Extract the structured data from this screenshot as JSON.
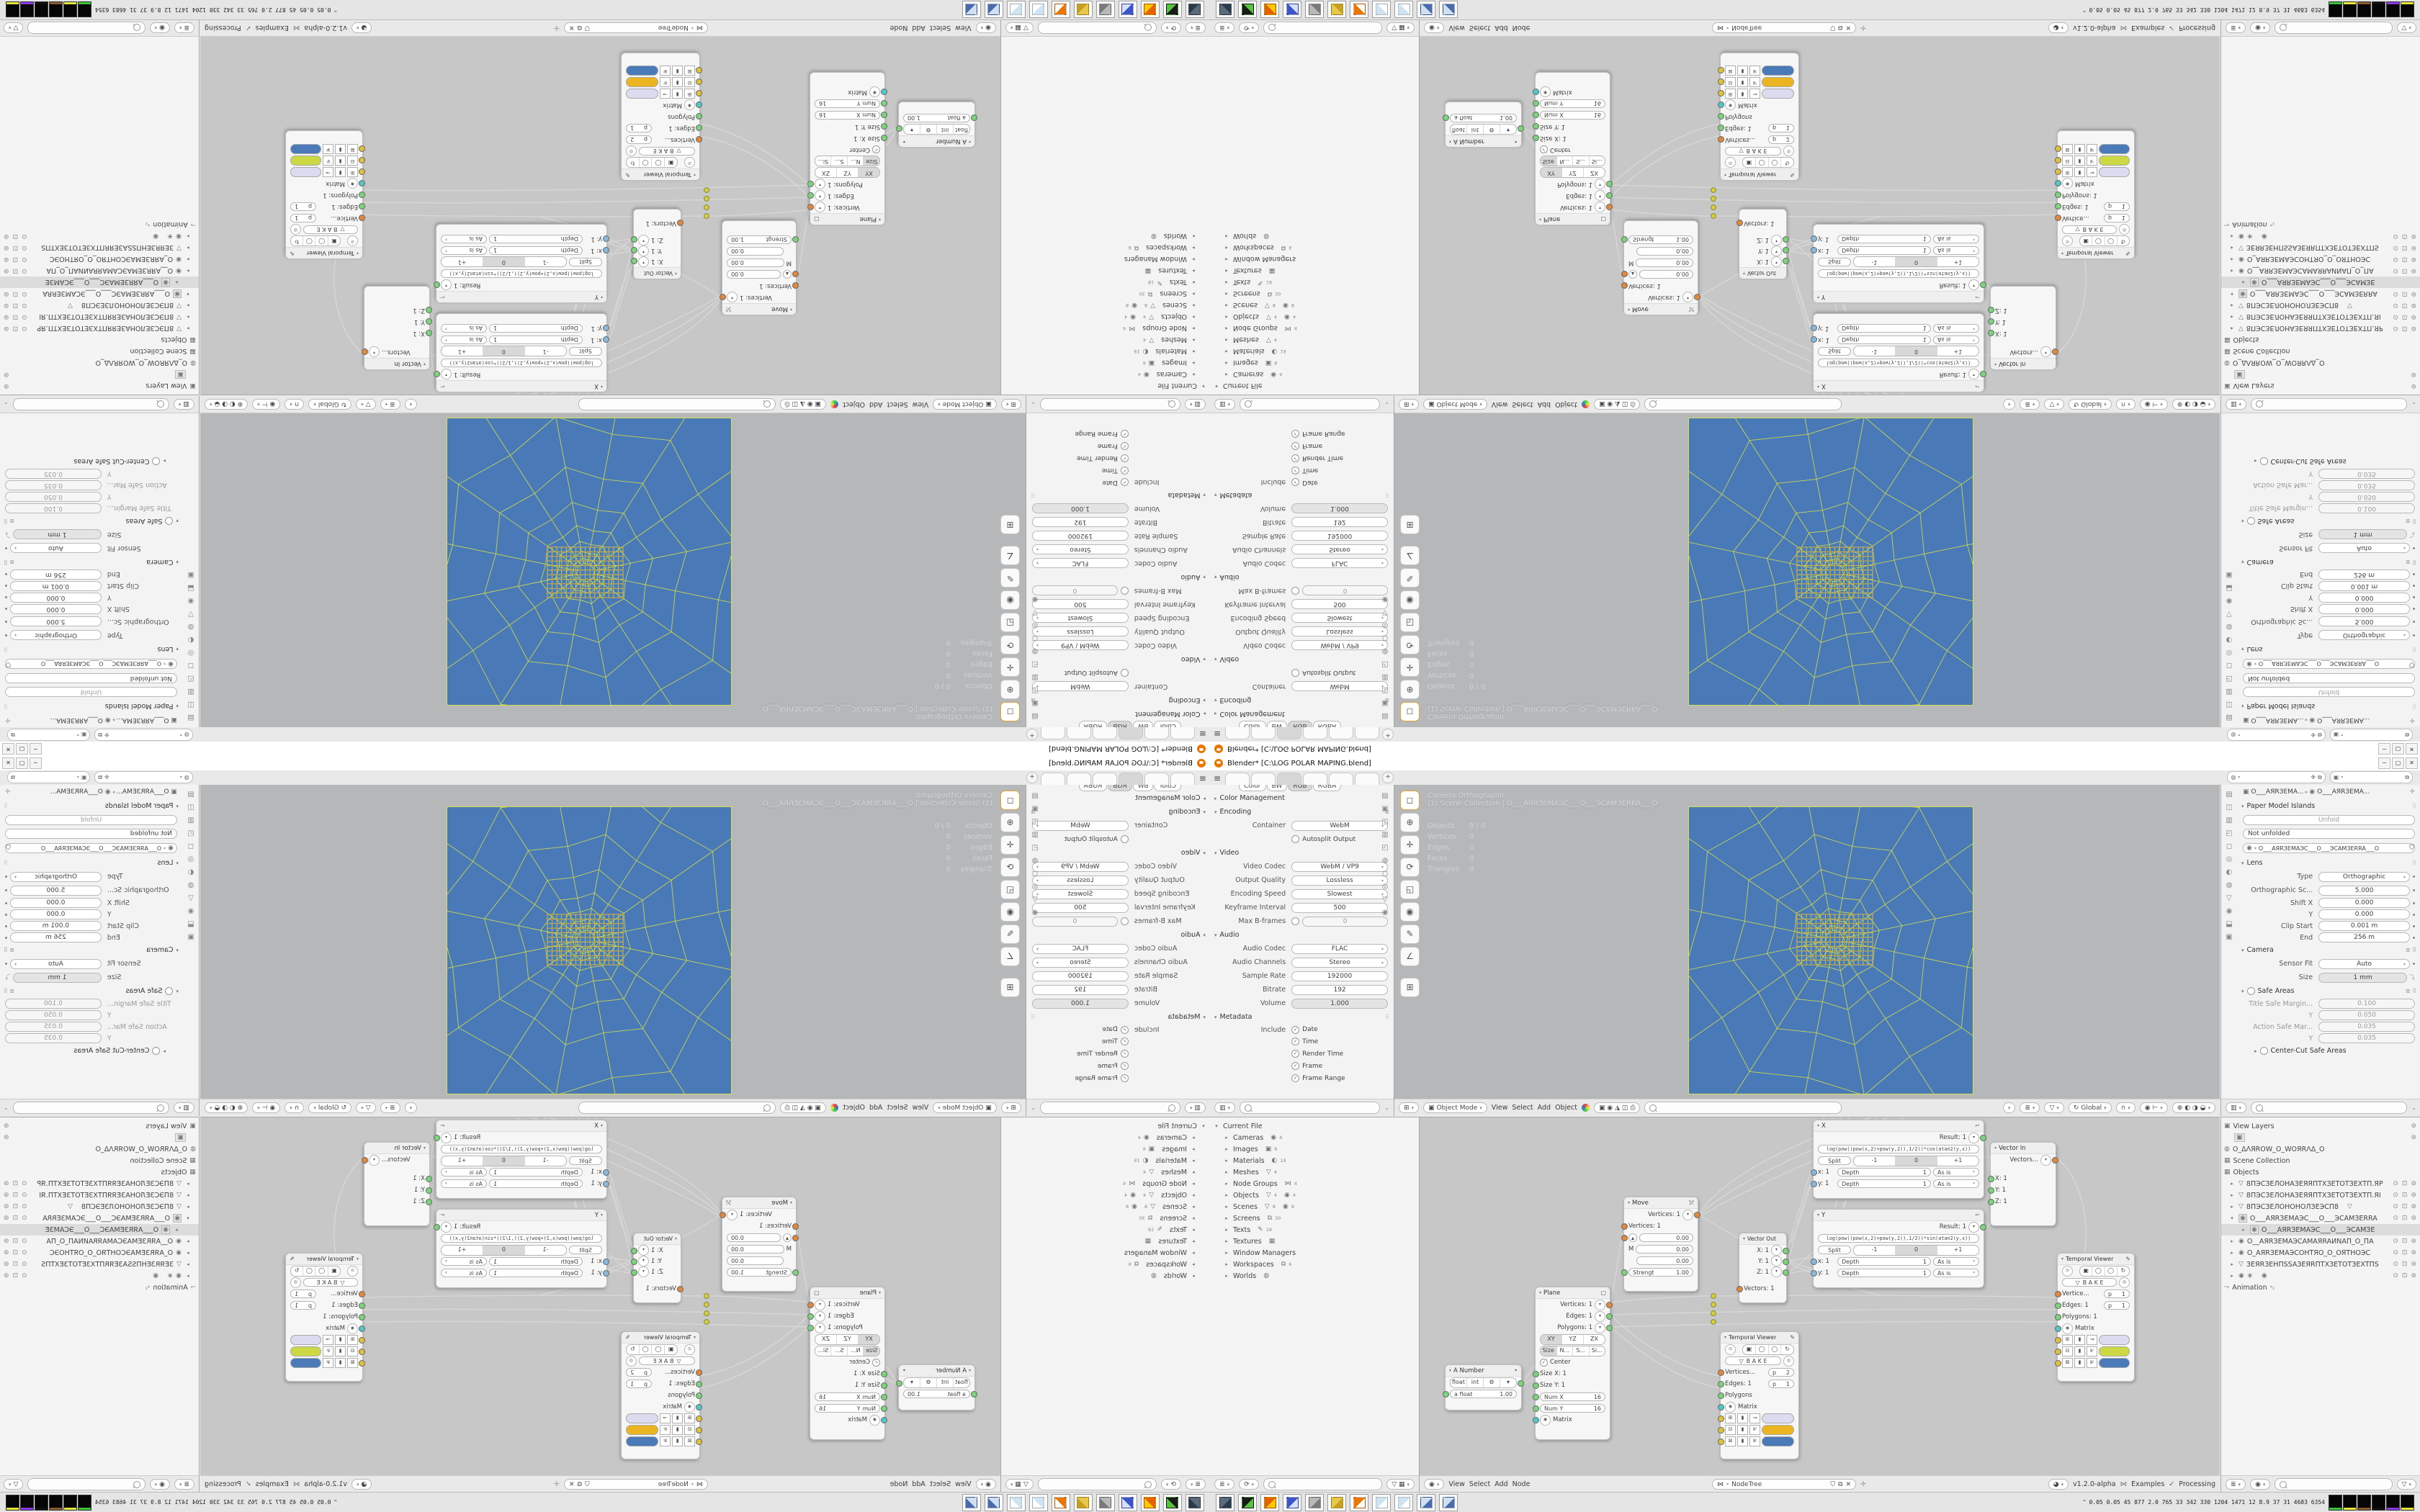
{
  "window": {
    "title": "Blender* [C:\\LOG POLAR MAPING.blend]",
    "buttons": [
      "─",
      "▢",
      "✕"
    ]
  },
  "topbar": {
    "tab_count": 6,
    "add": "+",
    "version_hint": ""
  },
  "output_props": {
    "color_row": [
      "Color",
      "BW",
      "RGB",
      "RGBA"
    ],
    "color_management": "Color Management",
    "encoding": "Encoding",
    "container_label": "Container",
    "container": "WebM",
    "autosplit": "Autosplit Output",
    "video": "Video",
    "video_codec_label": "Video Codec",
    "video_codec": "WebM / VP9",
    "output_quality_label": "Output Quality",
    "output_quality": "Lossless",
    "encoding_speed_label": "Encoding Speed",
    "encoding_speed": "Slowest",
    "keyframe_label": "Keyframe Interval",
    "keyframe": "500",
    "maxb_label": "Max B-frames",
    "maxb": "0",
    "audio": "Audio",
    "audio_codec_label": "Audio Codec",
    "audio_codec": "FLAC",
    "audio_channels_label": "Audio Channels",
    "audio_channels": "Stereo",
    "sample_rate_label": "Sample Rate",
    "sample_rate": "192000",
    "bitrate_label": "Bitrate",
    "bitrate": "192",
    "volume_label": "Volume",
    "volume": "1.000",
    "metadata": "Metadata",
    "include": "Include",
    "include_items": [
      "Date",
      "Time",
      "Render Time",
      "Frame",
      "Frame Range"
    ],
    "tab_glyphs": [
      "▤",
      "▣",
      "◫",
      "▥",
      "◰",
      "◍",
      "◻",
      "◎",
      "▽",
      "◉"
    ]
  },
  "viewport": {
    "overlay_line1": "Camera Orthographic",
    "overlay_line2": "(1) Scene Collection | O___AЯRЗEMAЭC___O___ЭCAMЗERRA___O",
    "stats": [
      [
        "Objects",
        "0 / 0"
      ],
      [
        "Vertices",
        "0"
      ],
      [
        "Edges",
        "0"
      ],
      [
        "Faces",
        "0"
      ],
      [
        "Triangles",
        "0"
      ]
    ],
    "toolbar_glyphs": [
      "◻",
      "⊕",
      "✛",
      "⟳",
      "◱",
      "◉",
      "✎",
      "∠",
      "⊞"
    ],
    "header": {
      "mode": "Object Mode",
      "menus": [
        "View",
        "Select",
        "Add",
        "Object"
      ],
      "orient": "Global"
    },
    "plane_color": "#4a79b8",
    "wire_color": "#ccd94e",
    "vertex_color": "#d89030"
  },
  "camera_props": {
    "breadcrumb_a": "O___AЯRЗEMA...",
    "breadcrumb_b": "O___AЯRЗEMA...",
    "paper_title": "Paper Model Islands",
    "unfold": "Unfold",
    "not_unfolded": "Not unfolded",
    "datablock": "O___AЯRЗEMAЭC___O___ЭCAMЗERRA___O",
    "lens": "Lens",
    "type_label": "Type",
    "type": "Orthographic",
    "ortho_label": "Orthographic Sc...",
    "ortho": "5.000",
    "shiftx_label": "Shift X",
    "shiftx": "0.000",
    "shifty_label": "Y",
    "shifty": "0.000",
    "clip_label": "Clip Start",
    "clip": "0.001 m",
    "end_label": "End",
    "end": "256 m",
    "camera": "Camera",
    "sensor_label": "Sensor Fit",
    "sensor": "Auto",
    "size_label": "Size",
    "size": "1 mm",
    "safe": "Safe Areas",
    "tsm_label": "Title Safe Margin...",
    "tsm": "0.100",
    "tsy_label": "Y",
    "tsy": "0.050",
    "asm_label": "Action Safe Mar...",
    "asm": "0.035",
    "asy_label": "Y",
    "asy": "0.035",
    "centercut": "Center-Cut Safe Areas",
    "tab_glyphs": [
      "▤",
      "◫",
      "▥",
      "◰",
      "◻",
      "◎",
      "◐",
      "◍",
      "▽",
      "◉",
      "⬓",
      "▣"
    ]
  },
  "outliner_file": {
    "root": "Current File",
    "items": [
      {
        "label": "Cameras",
        "icons": [
          [
            "◉",
            "4"
          ]
        ]
      },
      {
        "label": "Images",
        "icons": [
          [
            "▣",
            "6"
          ]
        ]
      },
      {
        "label": "Materials",
        "icons": [
          [
            "◐",
            "19"
          ]
        ]
      },
      {
        "label": "Meshes",
        "icons": [
          [
            "▽",
            "4"
          ]
        ]
      },
      {
        "label": "Node Groups",
        "icons": [
          [
            "⋈",
            "4"
          ]
        ]
      },
      {
        "label": "Objects",
        "icons": [
          [
            "▽",
            "4"
          ],
          [
            "◉",
            "4"
          ]
        ]
      },
      {
        "label": "Scenes",
        "icons": [
          [
            "▽",
            "8"
          ],
          [
            "◉",
            "8"
          ]
        ]
      },
      {
        "label": "Screens",
        "icons": [
          [
            "⧉",
            "30"
          ]
        ]
      },
      {
        "label": "Texts",
        "icons": [
          [
            "✎",
            "18"
          ]
        ]
      },
      {
        "label": "Textures",
        "icons": [
          [
            "▦",
            ""
          ]
        ]
      },
      {
        "label": "Window Managers",
        "icons": []
      },
      {
        "label": "Workspaces",
        "icons": [
          [
            "⧉",
            "6"
          ]
        ]
      },
      {
        "label": "Worlds",
        "icons": [
          [
            "◍",
            ""
          ]
        ]
      }
    ]
  },
  "node_editor": {
    "tree_name": "NodeTree",
    "header_menus": [
      "View",
      "Select",
      "Add",
      "Node"
    ],
    "version": "v1.2.0-alpha",
    "examples": "Examples",
    "processing": "Processing",
    "common": {
      "depth": "Depth",
      "one": "1",
      "asis": "As is",
      "split": "Split",
      "m1": "-1",
      "z": "0",
      "p1": "+1"
    },
    "nodes": {
      "anumber": {
        "title": "A Number",
        "b_float": "float",
        "b_int": "int",
        "afloat": "a float",
        "val": "1.00"
      },
      "plane": {
        "title": "Plane",
        "out_v": "Vertices: 1",
        "out_e": "Edges: 1",
        "out_p": "Polygons: 1",
        "xy": "XY",
        "yz": "YZ",
        "zx": "ZX",
        "size": "Size",
        "n": "N...",
        "s": "S...",
        "si": "Si...",
        "center": "Center",
        "sx": "Size X: 1",
        "sy": "Size Y: 1",
        "numx": "Num X",
        "numx_v": "16",
        "numy": "Num Y",
        "numy_v": "16",
        "matrix": "Matrix"
      },
      "move": {
        "title": "Move",
        "out_v": "Vertices: 1",
        "in_v": "Vertices: 1",
        "v0": "0.00",
        "m": "M",
        "v1": "0.00",
        "v2": "0.00",
        "strength": "Strengt",
        "strength_v": "1.00"
      },
      "vector_out": {
        "title": "Vector Out",
        "x": "X: 1",
        "y": "Y: 1",
        "z": "Z: 1",
        "vectors": "Vectors: 1"
      },
      "xnode": {
        "title": "X",
        "result": "Result: 1",
        "formula": "log(pow((pow(x,2)+pow(y,2)),1/2))*cos(atan2(y,x))",
        "in_x": "x: 1",
        "in_y": "y: 1"
      },
      "ynode": {
        "title": "Y",
        "result": "Result: 1",
        "formula": "log(pow((pow(x,2)+pow(y,2)),1/2))*sin(atan2(y,x))",
        "in_x": "x: 1",
        "in_y": "y: 1"
      },
      "vector_in": {
        "title": "Vector In",
        "vectors": "Vectors...",
        "x": "X: 1",
        "y": "Y: 1",
        "z": "Z: 1"
      },
      "tv_center": {
        "title": "Temporal Viewer",
        "bake": "B A K E",
        "in_v": "Vertices...",
        "pv": "p",
        "pvn": "2",
        "in_e": "Edges: 1",
        "pe": "p",
        "pen": "1",
        "in_p": "Polygons",
        "matrix": "Matrix",
        "sw1": "#dcdcf0",
        "sw2": "#eab520",
        "sw3": "#4a7ab8"
      },
      "tv_right": {
        "title": "Temporal Viewer",
        "bake": "B A K E",
        "in_v": "Vertice...",
        "pv": "p",
        "pvn": "1",
        "in_e": "Edges: 1",
        "pe": "p",
        "pen": "1",
        "in_p": "Polygons: 1",
        "matrix": "Matrix",
        "sw1": "#dcdcf0",
        "sw2": "#cdd845",
        "sw3": "#4a7ab8"
      }
    }
  },
  "outliner_viewlayer": {
    "view_layers": "View Layers",
    "world": "O_ΔΛЯROW_O_WOЯRΛΔ_O",
    "scene_collection": "Scene Collection",
    "objects": "Objects",
    "animation": "Animation",
    "anim_badge": "⁴₂",
    "items": [
      {
        "icon": "▽",
        "label": "8ПЭСЗЕЛОНАЗЕЯЯПТХЗЕТОТЗЕХТП.ЯР",
        "arrow": "▸",
        "tg": true
      },
      {
        "icon": "▽",
        "label": "8ПЭСЗЕЛОНАЗЕЯЯПТХЗЕТОТЗЕХТП.ЯI",
        "arrow": "▸",
        "tg": true
      },
      {
        "icon": "▽",
        "label": "8ПЭСЗЕЛОНОНОЛЗЕЭСП8",
        "extra": "▽",
        "arrow": "▸",
        "tg": true
      },
      {
        "icon": "◉",
        "label": "O___AЯRЗEMAЭC___O___ЭCAMЗERRA",
        "arrow": "▾",
        "tg": true,
        "boxed": true
      },
      {
        "icon": "◉",
        "label": "O___AЯRЗEMAЭC___O___ЭCAMЗE",
        "arrow": "▸",
        "child": true,
        "sel": true
      },
      {
        "icon": "◉",
        "label": "O__AЯRЗEMAЭCAMAЯRAИNAП_O_ПA",
        "arrow": "▸",
        "tg": true
      },
      {
        "icon": "◉",
        "label": "O_AЯRЗEMAЭCOHTЯO_O_OЯTHOЭC",
        "arrow": "▸",
        "tg": true
      },
      {
        "icon": "▽",
        "label": "ЗEЯRЗEHПSSAЗEЯRПТХЗЕТОТЗЕХТПS",
        "arrow": "▸",
        "tg": true
      },
      {
        "icon": "◉",
        "label": "✳",
        "extra": "◉",
        "arrow": "▸",
        "tg": true
      }
    ]
  },
  "taskbar": {
    "icons": [
      {
        "name": "computer",
        "c1": "#5a6a7a",
        "c2": "#2c3a4a"
      },
      {
        "name": "nvidia-drive",
        "c1": "#1a1a1a",
        "c2": "#57c340"
      },
      {
        "name": "firefox",
        "c1": "#e66000",
        "c2": "#ffcb00"
      },
      {
        "name": "floppy-64",
        "c1": "#3a55c8",
        "c2": "#d8e0ff"
      },
      {
        "name": "speaker",
        "c1": "#b8b8b8",
        "c2": "#7a7a7a"
      },
      {
        "name": "folder",
        "c1": "#e8c84a",
        "c2": "#c8a020"
      },
      {
        "name": "blender",
        "c1": "#ea7600",
        "c2": "#fff"
      },
      {
        "name": "notepad",
        "c1": "#cfe4f2",
        "c2": "#ffffff"
      },
      {
        "name": "notepad",
        "c1": "#cfe4f2",
        "c2": "#ffffff"
      },
      {
        "name": "calculator",
        "c1": "#cfe0f0",
        "c2": "#4a6ab0"
      },
      {
        "name": "calculator",
        "c1": "#cfe0f0",
        "c2": "#4a6ab0"
      }
    ],
    "tray_caret": "⌃",
    "tray_numbers": "0.05 0.05  45  877  2.0  765  33  342 330 1204 1471  12  8.9  37  31 4683 6354",
    "tray_blocks": [
      "#3bc43b",
      "#e6e63a",
      "#8a5a2a",
      "#101010",
      "#8a3ae6",
      "#e6e63a"
    ]
  }
}
